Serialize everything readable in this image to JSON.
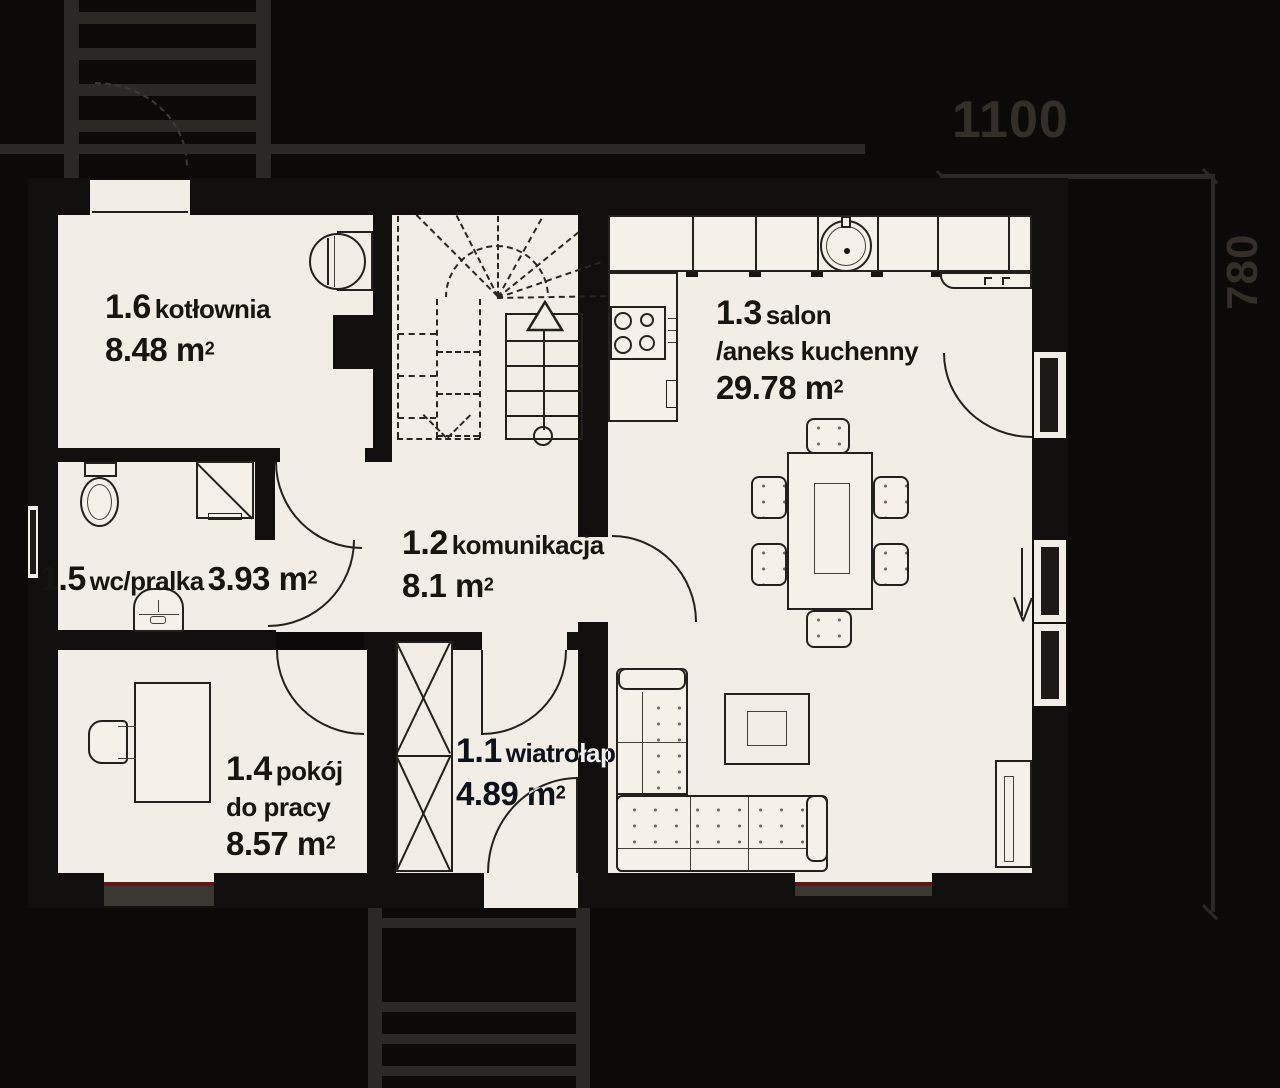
{
  "rooms": [
    {
      "num": "1.6",
      "name": "kotłownia",
      "area": "8.48 m",
      "sup": "2"
    },
    {
      "num": "1.5",
      "name": "wc/pralka",
      "area": "3.93 m",
      "sup": "2"
    },
    {
      "num": "1.2",
      "name": "komunikacja",
      "area": "8.1 m",
      "sup": "2"
    },
    {
      "num": "1.4",
      "name": "pokój",
      "name2": "do pracy",
      "area": "8.57 m",
      "sup": "2"
    },
    {
      "num": "1.1",
      "name": "wiatrołap",
      "area": "4.89 m",
      "sup": "2"
    },
    {
      "num": "1.3",
      "name": "salon",
      "name2": "/aneks kuchenny",
      "area": "29.78 m",
      "sup": "2"
    }
  ],
  "dimensions": {
    "width_label": "1100",
    "depth_label": "780"
  },
  "colors": {
    "floor": "#f3eee5",
    "wall": "#100f0d",
    "background": "#0b0a08",
    "dim_gray": "#332f28",
    "window_accent": "#5f1811"
  },
  "fixtures": [
    "boiler",
    "toilet",
    "shower",
    "washing-machine",
    "wardrobe",
    "desk",
    "desk-chair",
    "kitchen-counter",
    "sink",
    "hob",
    "stairs-up",
    "stairs-winder",
    "dining-table",
    "dining-chairs",
    "coffee-table",
    "corner-sofa",
    "fireplace",
    "entrance-door",
    "terrace-door",
    "windows",
    "exterior-steps"
  ]
}
